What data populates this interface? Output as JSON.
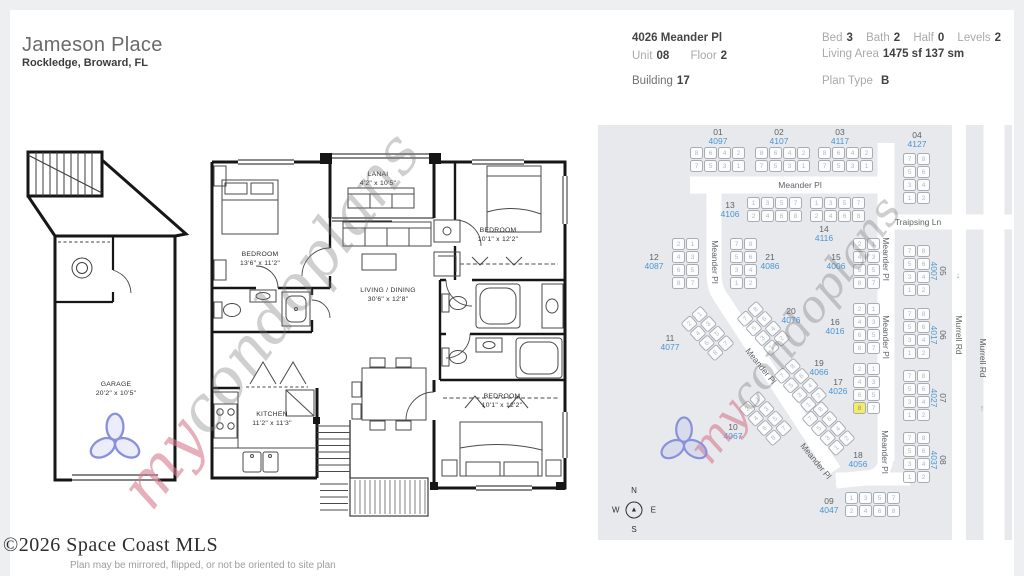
{
  "header": {
    "title": "Jameson Place",
    "subtitle": "Rockledge, Broward, FL",
    "address": "4026 Meander Pl",
    "unit_label": "Unit",
    "unit": "08",
    "floor_label": "Floor",
    "floor": "2",
    "building_label": "Building",
    "building": "17",
    "bed_label": "Bed",
    "bed": "3",
    "bath_label": "Bath",
    "bath": "2",
    "half_label": "Half",
    "half": "0",
    "levels_label": "Levels",
    "levels": "2",
    "living_area_label": "Living Area",
    "living_area": "1475 sf 137 sm",
    "plan_type_label": "Plan Type",
    "plan_type": "B"
  },
  "floorplan": {
    "rooms": [
      {
        "name": "BEDROOM",
        "dims": "13'6\" x 11'2\"",
        "x": 250,
        "y": 120
      },
      {
        "name": "LANAI",
        "dims": "4'2\" x 10'5\"",
        "x": 368,
        "y": 40
      },
      {
        "name": "LIVING / DINING",
        "dims": "30'6\" x 12'8\"",
        "x": 378,
        "y": 156
      },
      {
        "name": "BEDROOM",
        "dims": "10'1\" x 12'2\"",
        "x": 488,
        "y": 96
      },
      {
        "name": "KITCHEN",
        "dims": "11'2\" x 11'3\"",
        "x": 262,
        "y": 280
      },
      {
        "name": "BEDROOM",
        "dims": "10'1\" x 12'2\"",
        "x": 492,
        "y": 262
      },
      {
        "name": "GARAGE",
        "dims": "20'2\" x 10'5\"",
        "x": 106,
        "y": 250
      }
    ]
  },
  "sitemap": {
    "streets": [
      "Meander Pl",
      "Traipsing Ln",
      "Murrell Rd"
    ],
    "selected": {
      "building": "17",
      "unit": "8",
      "address": "4026"
    },
    "buildings": [
      {
        "num": "01",
        "address": "4097",
        "x": 92,
        "y": 22,
        "orient": "h",
        "units": [
          [
            8,
            6,
            4,
            2
          ],
          [
            7,
            5,
            3,
            1
          ]
        ],
        "label": {
          "x": 120,
          "y": 3
        }
      },
      {
        "num": "02",
        "address": "4107",
        "x": 157,
        "y": 22,
        "orient": "h",
        "units": [
          [
            8,
            6,
            4,
            2
          ],
          [
            7,
            5,
            3,
            1
          ]
        ],
        "label": {
          "x": 181,
          "y": 3
        }
      },
      {
        "num": "03",
        "address": "4117",
        "x": 220,
        "y": 22,
        "orient": "h",
        "units": [
          [
            8,
            6,
            4,
            2
          ],
          [
            7,
            5,
            3,
            1
          ]
        ],
        "label": {
          "x": 242,
          "y": 3
        }
      },
      {
        "num": "04",
        "address": "4127",
        "x": 305,
        "y": 28,
        "orient": "v",
        "units": [
          [
            7,
            8
          ],
          [
            5,
            6
          ],
          [
            3,
            4
          ],
          [
            1,
            2
          ]
        ],
        "label": {
          "x": 319,
          "y": 6
        }
      },
      {
        "num": "13",
        "address": "4106",
        "x": 149,
        "y": 72,
        "orient": "h",
        "units": [
          [
            1,
            3,
            5,
            7
          ],
          [
            2,
            4,
            6,
            8
          ]
        ],
        "label": {
          "x": 132,
          "y": 76
        }
      },
      {
        "num": "14",
        "address": "4116",
        "x": 212,
        "y": 72,
        "orient": "h",
        "units": [
          [
            1,
            3,
            5,
            7
          ],
          [
            2,
            4,
            6,
            8
          ]
        ],
        "label": {
          "x": 226,
          "y": 100
        }
      },
      {
        "num": "12",
        "address": "4087",
        "x": 74,
        "y": 113,
        "orient": "v",
        "units": [
          [
            2,
            1
          ],
          [
            4,
            3
          ],
          [
            6,
            5
          ],
          [
            8,
            7
          ]
        ],
        "label": {
          "x": 56,
          "y": 128
        }
      },
      {
        "num": "21",
        "address": "4086",
        "x": 132,
        "y": 113,
        "orient": "v",
        "units": [
          [
            7,
            8
          ],
          [
            5,
            6
          ],
          [
            3,
            4
          ],
          [
            1,
            2
          ]
        ],
        "label": {
          "x": 172,
          "y": 128
        }
      },
      {
        "num": "15",
        "address": "4006",
        "x": 255,
        "y": 113,
        "orient": "v",
        "units": [
          [
            2,
            1
          ],
          [
            4,
            3
          ],
          [
            6,
            5
          ],
          [
            8,
            7
          ]
        ],
        "label": {
          "x": 238,
          "y": 128
        }
      },
      {
        "num": "16",
        "address": "4016",
        "x": 255,
        "y": 178,
        "orient": "v",
        "units": [
          [
            2,
            1
          ],
          [
            4,
            3
          ],
          [
            6,
            5
          ],
          [
            8,
            7
          ]
        ],
        "label": {
          "x": 237,
          "y": 193
        }
      },
      {
        "num": "17",
        "address": "4026",
        "x": 255,
        "y": 238,
        "orient": "v",
        "units": [
          [
            2,
            1
          ],
          [
            4,
            3
          ],
          [
            6,
            5
          ],
          [
            8,
            7
          ]
        ],
        "highlight": "8",
        "label": {
          "x": 240,
          "y": 253
        }
      },
      {
        "num": "05",
        "address": "4007",
        "x": 305,
        "y": 120,
        "orient": "v",
        "units": [
          [
            7,
            8
          ],
          [
            5,
            6
          ],
          [
            3,
            4
          ],
          [
            1,
            2
          ]
        ],
        "label": {
          "x": 340,
          "y": 137,
          "rot": 90
        }
      },
      {
        "num": "06",
        "address": "4017",
        "x": 305,
        "y": 183,
        "orient": "v",
        "units": [
          [
            7,
            8
          ],
          [
            5,
            6
          ],
          [
            3,
            4
          ],
          [
            1,
            2
          ]
        ],
        "label": {
          "x": 340,
          "y": 201,
          "rot": 90
        }
      },
      {
        "num": "07",
        "address": "4027",
        "x": 305,
        "y": 245,
        "orient": "v",
        "units": [
          [
            7,
            8
          ],
          [
            5,
            6
          ],
          [
            3,
            4
          ],
          [
            1,
            2
          ]
        ],
        "label": {
          "x": 340,
          "y": 264,
          "rot": 90
        }
      },
      {
        "num": "08",
        "address": "4037",
        "x": 305,
        "y": 307,
        "orient": "v",
        "units": [
          [
            7,
            8
          ],
          [
            5,
            6
          ],
          [
            3,
            4
          ],
          [
            1,
            2
          ]
        ],
        "label": {
          "x": 340,
          "y": 326,
          "rot": 90
        }
      },
      {
        "num": "11",
        "address": "4077",
        "x": 96,
        "y": 183,
        "orient": "v",
        "rot": -42,
        "units": [
          [
            2,
            1
          ],
          [
            4,
            3
          ],
          [
            6,
            5
          ],
          [
            8,
            7
          ]
        ],
        "label": {
          "x": 72,
          "y": 209
        }
      },
      {
        "num": "20",
        "address": "4076",
        "x": 152,
        "y": 178,
        "orient": "v",
        "rot": -42,
        "units": [
          [
            7,
            8
          ],
          [
            5,
            6
          ],
          [
            3,
            4
          ],
          [
            1,
            2
          ]
        ],
        "label": {
          "x": 193,
          "y": 182
        }
      },
      {
        "num": "19",
        "address": "4066",
        "x": 189,
        "y": 235,
        "orient": "v",
        "rot": -42,
        "units": [
          [
            7,
            8
          ],
          [
            5,
            6
          ],
          [
            3,
            4
          ],
          [
            1,
            2
          ]
        ],
        "label": {
          "x": 221,
          "y": 234
        }
      },
      {
        "num": "10",
        "address": "4067",
        "x": 154,
        "y": 268,
        "orient": "v",
        "rot": -42,
        "units": [
          [
            2,
            1
          ],
          [
            4,
            3
          ],
          [
            6,
            5
          ],
          [
            8,
            7
          ]
        ],
        "label": {
          "x": 135,
          "y": 298
        }
      },
      {
        "num": "18",
        "address": "4056",
        "x": 217,
        "y": 278,
        "orient": "v",
        "rot": -42,
        "units": [
          [
            7,
            8
          ],
          [
            5,
            6
          ],
          [
            3,
            4
          ],
          [
            1,
            2
          ]
        ],
        "label": {
          "x": 260,
          "y": 326
        }
      },
      {
        "num": "09",
        "address": "4047",
        "x": 247,
        "y": 367,
        "orient": "h",
        "units": [
          [
            1,
            3,
            5,
            7
          ],
          [
            2,
            4,
            6,
            8
          ]
        ],
        "label": {
          "x": 231,
          "y": 372
        }
      }
    ],
    "street_labels": [
      {
        "text": "Meander Pl",
        "x": 202,
        "y": 60,
        "rot": 0
      },
      {
        "text": "Meander Pl",
        "x": 117,
        "y": 137,
        "rot": 90
      },
      {
        "text": "Meander Pl",
        "x": 288,
        "y": 134,
        "rot": 90
      },
      {
        "text": "Meander Pl",
        "x": 288,
        "y": 212,
        "rot": 90
      },
      {
        "text": "Meander Pl",
        "x": 287,
        "y": 327,
        "rot": 90
      },
      {
        "text": "Meander Pl",
        "x": 163,
        "y": 241,
        "rot": 51
      },
      {
        "text": "Meander Pl",
        "x": 218,
        "y": 336,
        "rot": 51
      },
      {
        "text": "Traipsing Ln",
        "x": 320,
        "y": 97,
        "rot": 0
      },
      {
        "text": "Murrell Rd",
        "x": 361,
        "y": 210,
        "rot": 90
      },
      {
        "text": "Murrell Rd",
        "x": 385,
        "y": 233,
        "rot": 90
      }
    ],
    "arrows": [
      {
        "glyph": "↓",
        "x": 360,
        "y": 150
      },
      {
        "glyph": "↑",
        "x": 384,
        "y": 283
      }
    ],
    "compass": {
      "n": "N",
      "e": "E",
      "s": "S",
      "w": "W",
      "needle": "▲"
    }
  },
  "watermark": {
    "prefix": "my",
    "suffix": "condoplans"
  },
  "footer": {
    "copyright": "©2026 Space Coast MLS",
    "disclaimer": "Plan may be mirrored, flipped, or not be oriented to site plan"
  },
  "colors": {
    "accent_address": "#4a96d4",
    "highlight_unit": "#f4ec62",
    "map_bg": "#e7e9ec",
    "road": "#ffffff",
    "watermark_pink": "rgba(213,122,144,0.6)",
    "watermark_gray": "rgba(118,118,118,0.35)",
    "trefoil": "#8b90dd"
  }
}
